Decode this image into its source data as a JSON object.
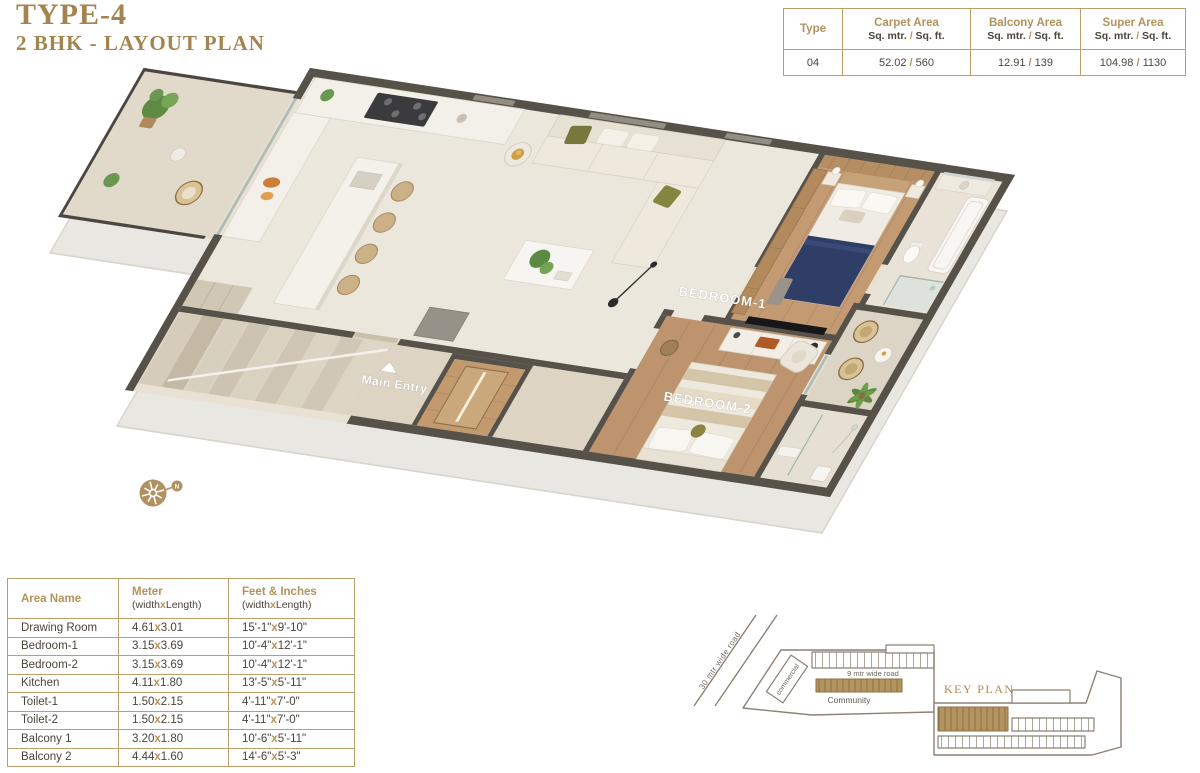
{
  "title": {
    "line1": "TYPE-4",
    "line2": "2 BHK - LAYOUT PLAN"
  },
  "area_table": {
    "col_type": "Type",
    "cols": [
      {
        "name": "Carpet Area",
        "units": [
          "Sq. mtr.",
          "Sq. ft."
        ]
      },
      {
        "name": "Balcony Area",
        "units": [
          "Sq. mtr.",
          "Sq. ft."
        ]
      },
      {
        "name": "Super Area",
        "units": [
          "Sq. mtr.",
          "Sq. ft."
        ]
      }
    ],
    "row": {
      "type": "04",
      "values": [
        [
          "52.02",
          "560"
        ],
        [
          "12.91",
          "139"
        ],
        [
          "104.98",
          "1130"
        ]
      ]
    }
  },
  "dimension_table": {
    "col1": "Area Name",
    "col2": {
      "name": "Meter",
      "sub": [
        "width",
        "Length"
      ]
    },
    "col3": {
      "name": "Feet & Inches",
      "sub": [
        "width",
        "Length"
      ]
    },
    "rows": [
      {
        "name": "Drawing Room",
        "meter": [
          "4.61",
          "3.01"
        ],
        "feet": [
          "15'-1\"",
          "9'-10\""
        ]
      },
      {
        "name": "Bedroom-1",
        "meter": [
          "3.15",
          "3.69"
        ],
        "feet": [
          "10'-4\"",
          "12'-1\""
        ]
      },
      {
        "name": "Bedroom-2",
        "meter": [
          "3.15",
          "3.69"
        ],
        "feet": [
          "10'-4\"",
          "12'-1\""
        ]
      },
      {
        "name": "Kitchen",
        "meter": [
          "4.11",
          "1.80"
        ],
        "feet": [
          "13'-5\"",
          "5'-11\""
        ]
      },
      {
        "name": "Toilet-1",
        "meter": [
          "1.50",
          "2.15"
        ],
        "feet": [
          "4'-11\"",
          "7'-0\""
        ]
      },
      {
        "name": "Toilet-2",
        "meter": [
          "1.50",
          "2.15"
        ],
        "feet": [
          "4'-11\"",
          "7'-0\""
        ]
      },
      {
        "name": "Balcony 1",
        "meter": [
          "3.20",
          "1.80"
        ],
        "feet": [
          "10'-6\"",
          "5'-11\""
        ]
      },
      {
        "name": "Balcony 2",
        "meter": [
          "4.44",
          "1.60"
        ],
        "feet": [
          "14'-6\"",
          "5'-3\""
        ]
      }
    ]
  },
  "plan_labels": {
    "bedroom1": "BEDROOM-1",
    "bedroom2": "BEDROOM-2",
    "main_entry": "Main Entry",
    "compass_n": "N"
  },
  "key_plan": {
    "title": "KEY PLAN",
    "road30": "30 mtr wide road",
    "road9": "9 mtr wide road",
    "community": "Community",
    "commercial": "commercial"
  },
  "colors": {
    "gold_text": "#a5834e",
    "table_border": "#bb9e6b",
    "dark_text": "#4a443c",
    "wall": "#56524a",
    "gold_block": "#b3945f",
    "navy_bed": "#2e3e66"
  }
}
